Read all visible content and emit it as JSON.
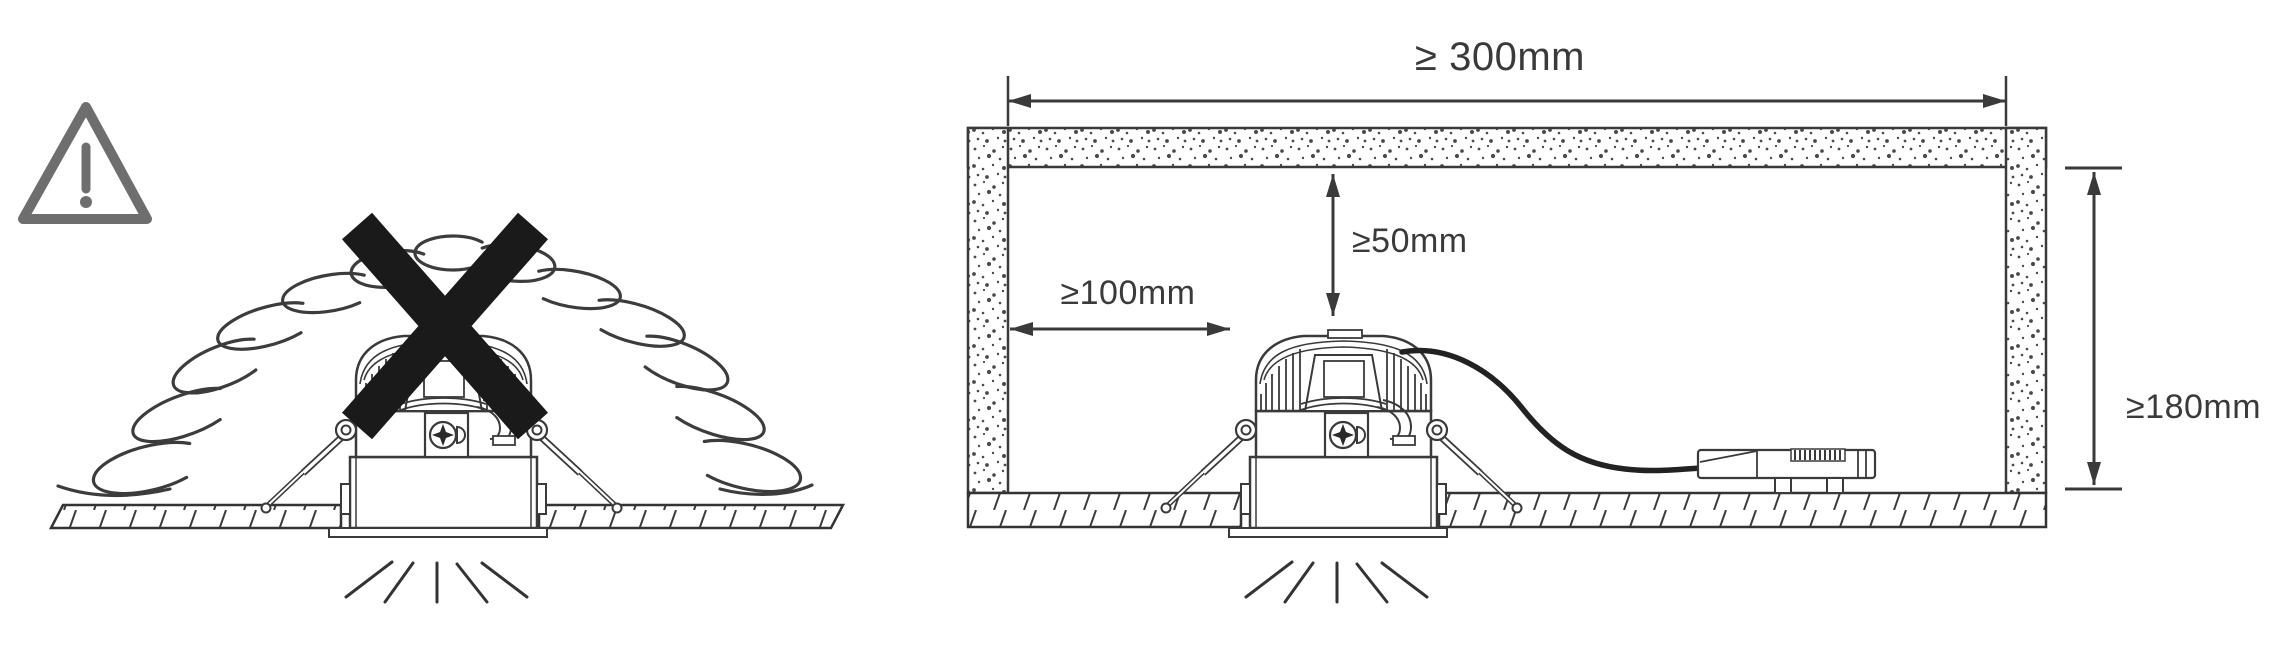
{
  "figure_left": {
    "name": "do-not-cover-with-insulation",
    "warning_icon": "warning-triangle-icon",
    "cross_icon": "prohibition-cross-icon"
  },
  "figure_right": {
    "name": "installation-clearances",
    "dims": {
      "width": "≥ 300mm",
      "top": "≥50mm",
      "side": "≥100mm",
      "height": "≥180mm"
    }
  },
  "colors": {
    "line": "#3a3a3a",
    "warning": "#6e6e6e",
    "cross": "#1a1a1a",
    "background": "#ffffff"
  }
}
